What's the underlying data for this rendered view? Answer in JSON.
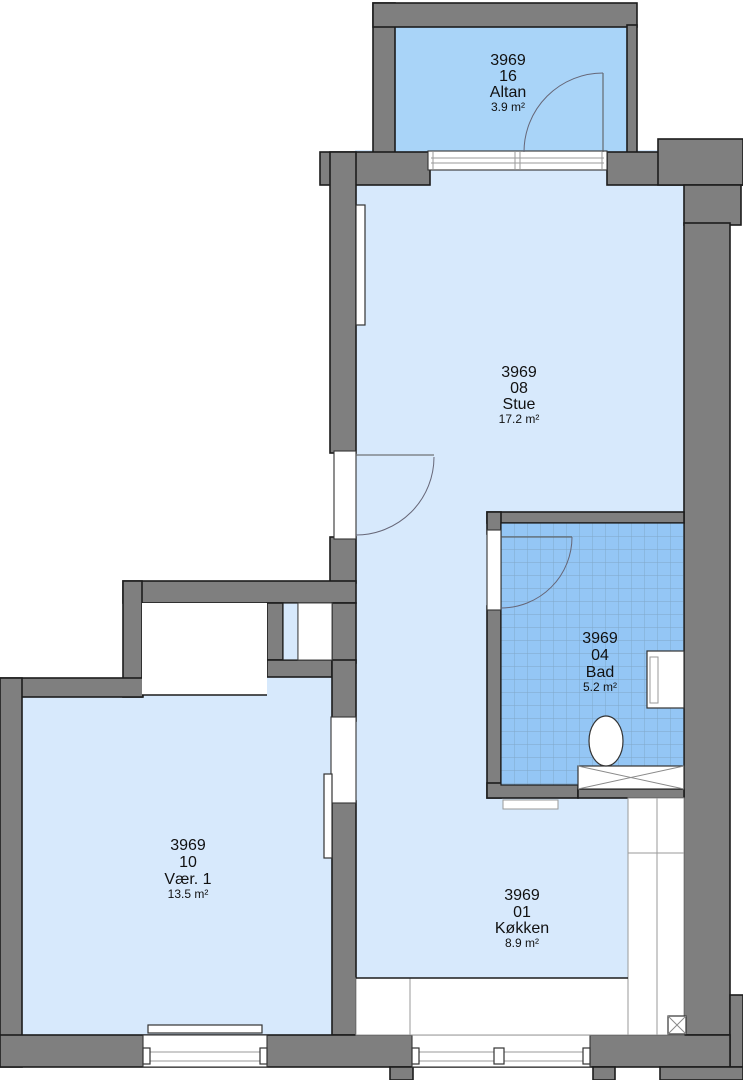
{
  "colors": {
    "wall": "#7f7f7f",
    "outline": "#1c1c1c",
    "room": "#d7e9fc",
    "balcony": "#a9d4f8",
    "bath": "#94c6f5",
    "bathgrid": "#7fa6c8",
    "text": "#111111"
  },
  "rooms": [
    {
      "number": "3969",
      "unit": "16",
      "name": "Altan",
      "area": "3.9 m²"
    },
    {
      "number": "3969",
      "unit": "08",
      "name": "Stue",
      "area": "17.2 m²"
    },
    {
      "number": "3969",
      "unit": "04",
      "name": "Bad",
      "area": "5.2 m²"
    },
    {
      "number": "3969",
      "unit": "10",
      "name": "Vær. 1",
      "area": "13.5 m²"
    },
    {
      "number": "3969",
      "unit": "01",
      "name": "Køkken",
      "area": "8.9 m²"
    }
  ]
}
